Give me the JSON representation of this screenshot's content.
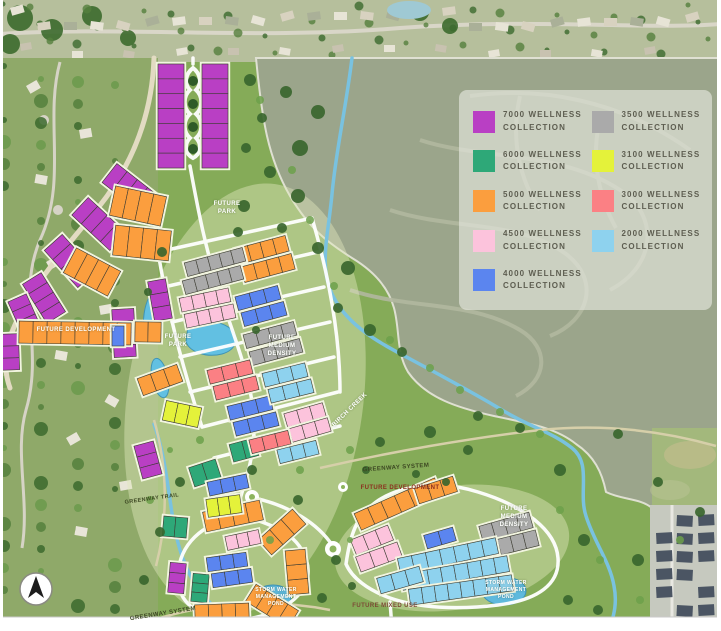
{
  "legend": {
    "items": [
      {
        "label": "7000 WELLNESS\nCOLLECTION",
        "color": "#b93fc4"
      },
      {
        "label": "6000 WELLNESS\nCOLLECTION",
        "color": "#2ea878"
      },
      {
        "label": "5000 WELLNESS\nCOLLECTION",
        "color": "#fb9e3e"
      },
      {
        "label": "4500 WELLNESS\nCOLLECTION",
        "color": "#fcc3dc"
      },
      {
        "label": "4000 WELLNESS\nCOLLECTION",
        "color": "#5b85ef"
      },
      {
        "label": "3500 WELLNESS\nCOLLECTION",
        "color": "#aaaaaa"
      },
      {
        "label": "3100 WELLNESS\nCOLLECTION",
        "color": "#e4f23a"
      },
      {
        "label": "3000 WELLNESS\nCOLLECTION",
        "color": "#fb8084"
      },
      {
        "label": "2000 WELLNESS\nCOLLECTION",
        "color": "#8ed2ee"
      }
    ]
  },
  "labels": [
    {
      "id": "future-park-north",
      "text": "FUTURE\nPARK"
    },
    {
      "id": "future-park-west",
      "text": "FUTURE\nPARK"
    },
    {
      "id": "future-medium-density-central",
      "text": "FUTURE\nMEDIUM\nDENSITY"
    },
    {
      "id": "future-development-west",
      "text": "FUTURE DEVELOPMENT"
    },
    {
      "id": "birch-creek",
      "text": "BIRCH CREEK"
    },
    {
      "id": "greenway-system-central",
      "text": "GREENWAY SYSTEM"
    },
    {
      "id": "future-development-southeast",
      "text": "FUTURE DEVELOPMENT"
    },
    {
      "id": "future-medium-density-east",
      "text": "FUTURE\nMEDIUM\nDENSITY"
    },
    {
      "id": "storm-water-pond-southwest",
      "text": "STORM WATER\nMANAGEMENT\nPOND"
    },
    {
      "id": "storm-water-pond-southeast",
      "text": "STORM WATER\nMANAGEMENT\nPOND"
    },
    {
      "id": "future-mixed-use",
      "text": "FUTURE MIXED USE"
    },
    {
      "id": "greenway-system-south",
      "text": "GREENWAY SYSTEM"
    },
    {
      "id": "greenway-trail",
      "text": "GREENWAY TRAIL"
    }
  ]
}
